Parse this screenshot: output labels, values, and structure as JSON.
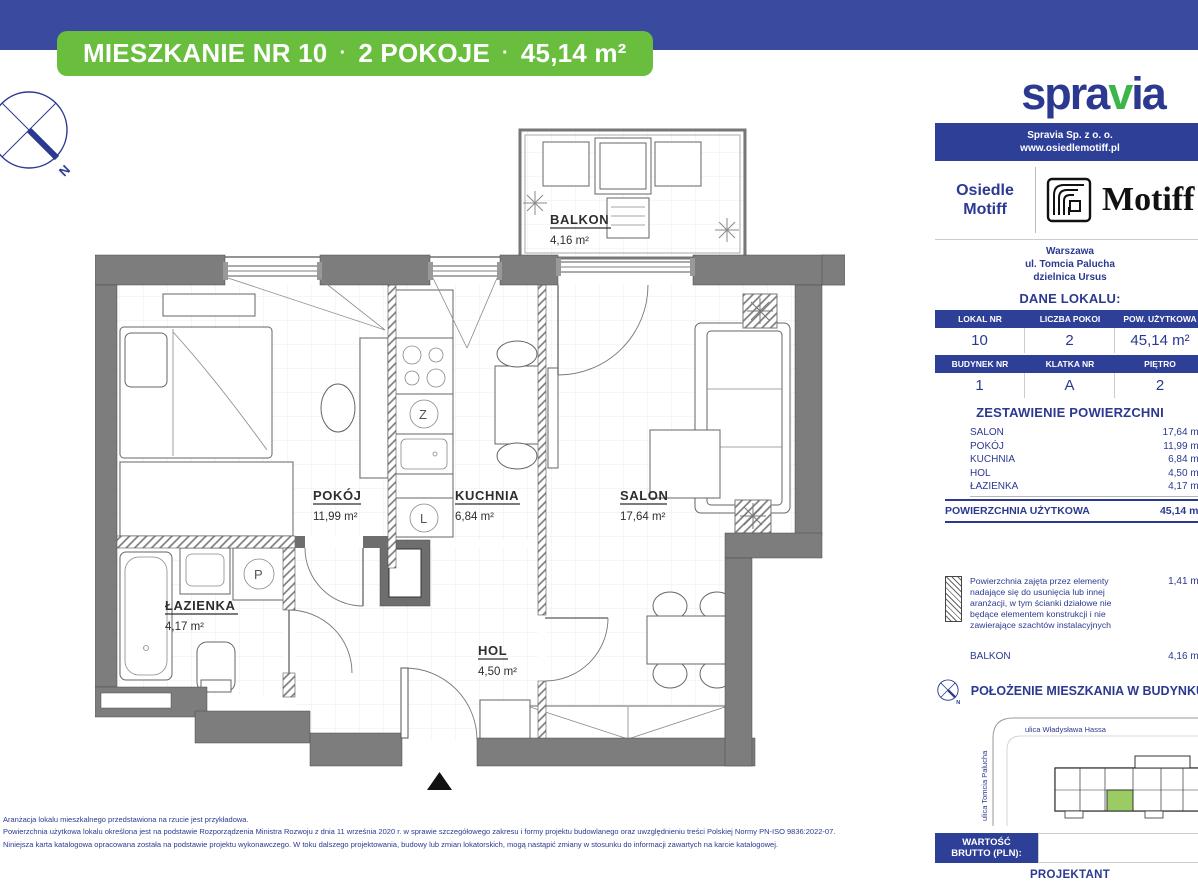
{
  "top_badge": {
    "unit": "MIESZKANIE NR 10",
    "sep": "·",
    "rooms": "2 POKOJE",
    "area": "45,14 m²"
  },
  "logo": {
    "part1": "spra",
    "part2": "v",
    "part3": "ia"
  },
  "company_bar": {
    "name": "Spravia Sp. z o. o.",
    "website": "www.osiedlemotiff.pl"
  },
  "estate": {
    "name": "Osiedle Motiff",
    "brand": "Motiff",
    "city": "Warszawa",
    "street": "ul. Tomcia Palucha",
    "district": "dzielnica Ursus"
  },
  "dane_lokalu": {
    "title": "DANE LOKALU:",
    "headers1": [
      "LOKAL NR",
      "LICZBA POKOI",
      "POW. UŻYTKOWA"
    ],
    "values1": [
      "10",
      "2",
      "45,14 m²"
    ],
    "headers2": [
      "BUDYNEK NR",
      "KLATKA NR",
      "PIĘTRO"
    ],
    "values2": [
      "1",
      "A",
      "2"
    ]
  },
  "zestawienie": {
    "title": "ZESTAWIENIE POWIERZCHNI",
    "rows": [
      {
        "label": "SALON",
        "value": "17,64 m²"
      },
      {
        "label": "POKÓJ",
        "value": "11,99 m²"
      },
      {
        "label": "KUCHNIA",
        "value": "6,84 m²"
      },
      {
        "label": "HOL",
        "value": "4,50 m²"
      },
      {
        "label": "ŁAZIENKA",
        "value": "4,17 m²"
      }
    ],
    "total": {
      "label": "POWIERZCHNIA UŻYTKOWA",
      "value": "45,14 m²"
    }
  },
  "note": {
    "text": "Powierzchnia zajęta przez elementy nadające się do usunięcia lub innej aranżacji, w tym ścianki działowe nie będące elementem konstrukcji i nie zawierające szachtów instalacyjnych",
    "value": "1,41 m²"
  },
  "balkon_row": {
    "label": "BALKON",
    "value": "4,16 m²"
  },
  "location": {
    "title": "POŁOŻENIE MIESZKANIA W BUDYNKU",
    "street_h": "ulica Władysława Hassa",
    "street_v": "ulica Tomcia Palucha"
  },
  "price": {
    "label": "WARTOŚĆ\nBRUTTO (PLN):"
  },
  "projektant": "PROJEKTANT",
  "plan": {
    "rooms": [
      {
        "name": "POKÓJ",
        "area": "11,99 m²"
      },
      {
        "name": "KUCHNIA",
        "area": "6,84 m²"
      },
      {
        "name": "SALON",
        "area": "17,64 m²"
      },
      {
        "name": "ŁAZIENKA",
        "area": "4,17 m²"
      },
      {
        "name": "HOL",
        "area": "4,50 m²"
      },
      {
        "name": "BALKON",
        "area": "4,16 m²"
      }
    ],
    "appliances": {
      "z": "Z",
      "l": "L",
      "p": "P"
    },
    "compass_n": "N"
  },
  "disclaimer": {
    "line1": "Aranżacja lokalu mieszkalnego przedstawiona na rzucie jest przykładowa.",
    "line2": "Powierzchnia użytkowa lokalu określona jest na podstawie Rozporządzenia Ministra Rozwoju z dnia 11 września 2020 r. w sprawie szczegółowego zakresu i formy projektu budowlanego oraz uwzględnieniu treści Polskiej Normy PN-ISO 9836:2022-07.",
    "line3": "Niniejsza karta katalogowa opracowana została na podstawie projektu wykonawczego. W toku dalszego projektowania, budowy lub zmian lokatorskich, mogą nastąpić zmiany w stosunku do informacji zawartych na karcie katalogowej."
  },
  "colors": {
    "navy": "#2B3990",
    "bar_blue": "#3A4A9E",
    "green": "#69BE3E",
    "wall_gray": "#7D7D7D",
    "unit_green": "#9BCB63"
  }
}
